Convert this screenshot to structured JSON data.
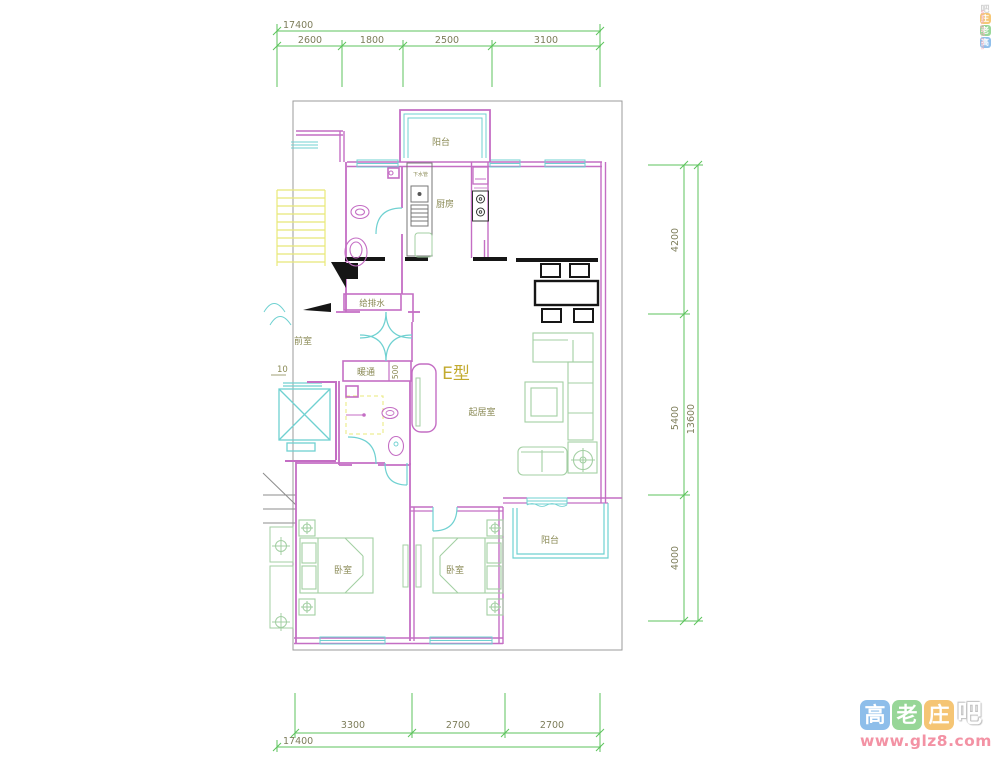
{
  "plan": {
    "unit_type": "E型",
    "labels": {
      "balcony_top": "阳台",
      "kitchen": "厨房",
      "drain_pipe": "下水管",
      "plumbing_shaft": "给排水",
      "front_room": "前室",
      "hvac": "暖通",
      "hvac_width": "500",
      "living_room": "起居室",
      "bedroom_left": "卧室",
      "bedroom_right": "卧室",
      "balcony_bottom": "阳台",
      "left_partial_dim": "10"
    }
  },
  "dims": {
    "top_overall": "17400",
    "top_segments": [
      "2600",
      "1800",
      "2500",
      "3100"
    ],
    "right_segments": [
      "4200",
      "5400",
      "4000"
    ],
    "right_overall": "13600",
    "bottom_segments": [
      "3300",
      "2700",
      "2700"
    ],
    "bottom_overall": "17400"
  },
  "watermark": {
    "char_gao": "高",
    "char_lao": "老",
    "char_zhuang": "庄",
    "char_ba": "吧",
    "site": "www.glz8.com"
  },
  "colors": {
    "wall": "#c46ec4",
    "window": "#6fd1d1",
    "dimension_line": "#5cc35c",
    "dimension_text": "#7d7d5a",
    "room_label": "#8a8a55",
    "unit_title": "#c2aa2e",
    "furniture_green": "#a3cfa3",
    "stairs_yellow": "#e8e878",
    "heavy_black": "#161616",
    "boundary_gray": "#9b9b9b"
  }
}
